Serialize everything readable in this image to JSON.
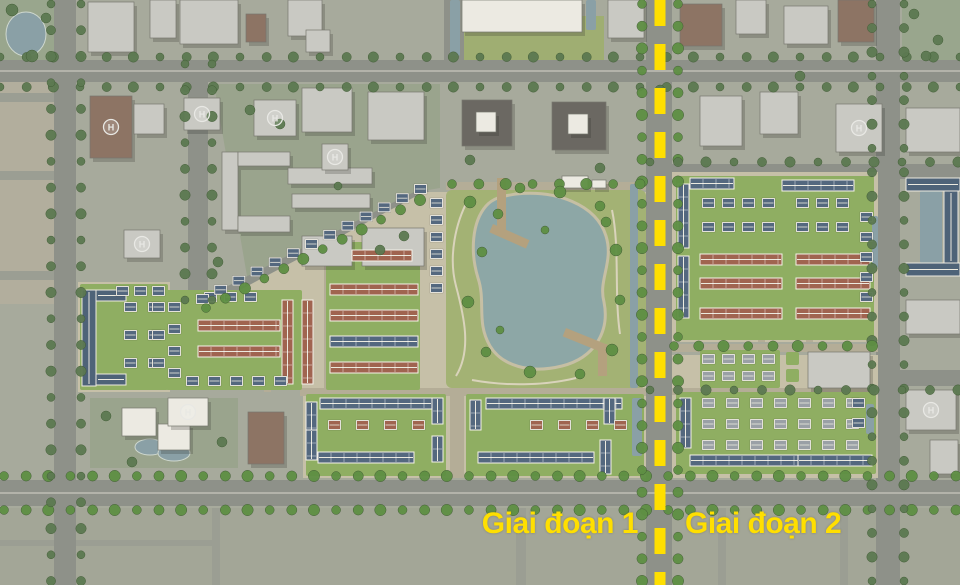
{
  "labels": {
    "phase1": "Giai đoạn 1",
    "phase2": "Giai đoạn 2"
  },
  "colors": {
    "bg": "#a7aa9c",
    "road": "#8e9189",
    "roadLine": "#b3b3aa",
    "minor": "#b4ad97",
    "faintRoad": "#9b9e93",
    "tan": "#c6c0a8",
    "lawn": "#8fae62",
    "parkG": "#a3b274",
    "radialPark": "#9fae72",
    "water": "#8da7a6",
    "waterDim": "#8aa0a6",
    "sand": "#c6bfa4",
    "treeB": "#5e8f43",
    "treeD": "#5c7951",
    "treeEdge": "#3f5a33",
    "bldg": "#c9c9c3",
    "bldgW": "#eceae2",
    "brown": "#8d7464",
    "dark": "#6b6862",
    "bldgEdge": "#77776e",
    "roofBlue": "#54687f",
    "roofRed": "#a06450",
    "roofGray": "#9aa0a6",
    "bar": "#4e6378",
    "ridge": "#eceadf",
    "pier": "#b4a17e",
    "beige": "#b2ae9d",
    "schoolTint": "#9aa48d",
    "parkTint": "#99a68d",
    "bottomBand": "#a3a697",
    "accent": "#ffdf00"
  },
  "map": {
    "w": 960,
    "h": 585,
    "helipad_glyph": "H",
    "parcels": [
      {
        "r": [
          0,
          0,
          58,
          66
        ],
        "f": "parkTint"
      },
      {
        "r": [
          902,
          0,
          58,
          62
        ],
        "f": "parkTint"
      },
      {
        "r": [
          0,
          66,
          56,
          160
        ],
        "f": "beige"
      },
      {
        "r": [
          0,
          226,
          56,
          78
        ],
        "f": "beige"
      },
      {
        "p": "214,84 440,84 440,188 416,192 248,282",
        "f": "schoolTint"
      },
      {
        "r": [
          90,
          398,
          148,
          70
        ],
        "f": "schoolTint"
      },
      {
        "r": [
          444,
          16,
          160,
          66
        ],
        "f": "radialPark"
      },
      {
        "r": [
          0,
          508,
          960,
          77
        ],
        "f": "bottomBand"
      }
    ],
    "faintRoads": [
      [
        212,
        508,
        8,
        77
      ],
      [
        516,
        508,
        10,
        77
      ],
      [
        718,
        508,
        8,
        77
      ],
      [
        840,
        508,
        8,
        77
      ],
      [
        0,
        540,
        212,
        6
      ],
      [
        58,
        508,
        8,
        77
      ],
      [
        0,
        93,
        56,
        9
      ],
      [
        0,
        171,
        56,
        9
      ],
      [
        0,
        271,
        56,
        9
      ]
    ],
    "roads": [
      [
        0,
        60,
        960,
        22
      ],
      [
        0,
        480,
        960,
        26
      ],
      [
        648,
        164,
        312,
        15
      ],
      [
        648,
        370,
        312,
        16
      ],
      [
        54,
        0,
        22,
        585
      ],
      [
        188,
        60,
        20,
        246
      ],
      [
        444,
        0,
        20,
        62
      ],
      [
        646,
        0,
        26,
        585
      ],
      [
        876,
        0,
        24,
        585
      ]
    ],
    "roadLines": [
      [
        0,
        70,
        960,
        2
      ],
      [
        0,
        492,
        960,
        2
      ]
    ],
    "diagRoads": [
      [
        206,
        302,
        424,
        192,
        9
      ]
    ],
    "bright": [
      {
        "r": [
          78,
          282,
          92,
          110
        ]
      },
      {
        "p": "170,290 240,290 424,192 646,192 646,478 303,478 303,390 170,390"
      },
      {
        "r": [
          672,
          172,
          206,
          170
        ]
      },
      {
        "r": [
          672,
          355,
          206,
          123
        ]
      }
    ],
    "minorRoads": [
      [
        300,
        388,
        346,
        8
      ],
      [
        446,
        182,
        200,
        8
      ],
      [
        450,
        392,
        14,
        86
      ],
      [
        672,
        344,
        206,
        8
      ],
      [
        672,
        388,
        206,
        7
      ],
      [
        758,
        178,
        7,
        164
      ],
      [
        806,
        178,
        7,
        164
      ],
      [
        324,
        242,
        7,
        146
      ],
      [
        264,
        298,
        7,
        94
      ]
    ],
    "lawns": [
      [
        80,
        284,
        88,
        106
      ],
      [
        166,
        290,
        136,
        100
      ],
      [
        326,
        242,
        94,
        148
      ],
      [
        306,
        394,
        140,
        82
      ],
      [
        466,
        394,
        178,
        82
      ],
      [
        676,
        176,
        198,
        164
      ],
      [
        676,
        392,
        200,
        82
      ],
      [
        700,
        350,
        80,
        38
      ],
      [
        786,
        352,
        13,
        13
      ],
      [
        786,
        369,
        13,
        13
      ]
    ],
    "park": {
      "rect": [
        446,
        190,
        200,
        198
      ],
      "lake": "M516,194 C556,190 596,204 606,236 C614,262 598,280 604,302 C610,332 594,358 562,366 C530,374 502,366 490,346 C476,322 486,302 478,278 C470,252 472,222 486,206 C494,197 504,196 516,194 Z",
      "paths": [
        "M456,376 C472,350 464,316 456,286 C448,256 456,222 468,200",
        "M472,380 C504,386 544,386 576,378",
        "M612,210 C620,248 614,294 620,334"
      ],
      "piers": [
        [
          497,
          178,
          9,
          52,
          0
        ],
        [
          493,
          224,
          40,
          9,
          24
        ],
        [
          598,
          344,
          9,
          32,
          0
        ],
        [
          566,
          328,
          42,
          9,
          22
        ]
      ]
    },
    "canals": [
      [
        450,
        0,
        10,
        56
      ],
      [
        586,
        0,
        10,
        30
      ],
      [
        630,
        184,
        8,
        204
      ],
      [
        866,
        404,
        8,
        30
      ],
      [
        632,
        398,
        10,
        58
      ],
      [
        920,
        191,
        22,
        72
      ],
      [
        872,
        216,
        6,
        52
      ]
    ],
    "pools": [
      [
        26,
        34,
        20,
        22
      ],
      [
        150,
        447,
        15,
        8
      ],
      [
        174,
        453,
        16,
        8
      ]
    ],
    "buildings": [
      [
        88,
        2,
        46,
        50,
        "g"
      ],
      [
        150,
        0,
        26,
        38,
        "g"
      ],
      [
        180,
        0,
        58,
        44,
        "g"
      ],
      [
        246,
        14,
        20,
        28,
        "b"
      ],
      [
        288,
        0,
        34,
        36,
        "g"
      ],
      [
        306,
        30,
        24,
        22,
        "g"
      ],
      [
        462,
        0,
        120,
        32,
        "w"
      ],
      [
        608,
        0,
        36,
        38,
        "g"
      ],
      [
        680,
        4,
        42,
        42,
        "b"
      ],
      [
        736,
        0,
        30,
        34,
        "g"
      ],
      [
        784,
        6,
        44,
        38,
        "g"
      ],
      [
        838,
        0,
        36,
        42,
        "b"
      ],
      [
        90,
        96,
        42,
        62,
        "b"
      ],
      [
        134,
        104,
        30,
        30,
        "g"
      ],
      [
        124,
        230,
        36,
        28,
        "g"
      ],
      [
        184,
        98,
        36,
        32,
        "g"
      ],
      [
        254,
        100,
        42,
        36,
        "g"
      ],
      [
        302,
        88,
        50,
        44,
        "g"
      ],
      [
        368,
        92,
        56,
        48,
        "g"
      ],
      [
        462,
        100,
        50,
        46,
        "d"
      ],
      [
        476,
        112,
        20,
        20,
        "w"
      ],
      [
        552,
        102,
        54,
        48,
        "d"
      ],
      [
        568,
        114,
        20,
        20,
        "w"
      ],
      [
        700,
        96,
        42,
        50,
        "g"
      ],
      [
        760,
        92,
        38,
        42,
        "g"
      ],
      [
        836,
        104,
        46,
        48,
        "g"
      ],
      [
        906,
        108,
        54,
        44,
        "g"
      ],
      [
        222,
        152,
        16,
        78,
        "g"
      ],
      [
        238,
        152,
        52,
        14,
        "g"
      ],
      [
        238,
        216,
        52,
        16,
        "g"
      ],
      [
        288,
        168,
        84,
        16,
        "g"
      ],
      [
        292,
        194,
        78,
        14,
        "g"
      ],
      [
        322,
        144,
        26,
        26,
        "g"
      ],
      [
        362,
        228,
        62,
        38,
        "g"
      ],
      [
        302,
        236,
        50,
        30,
        "g"
      ],
      [
        122,
        408,
        34,
        28,
        "w"
      ],
      [
        158,
        424,
        32,
        26,
        "w"
      ],
      [
        168,
        398,
        40,
        28,
        "w"
      ],
      [
        248,
        412,
        36,
        52,
        "b"
      ],
      [
        906,
        300,
        54,
        34,
        "g"
      ],
      [
        906,
        390,
        50,
        40,
        "g"
      ],
      [
        930,
        440,
        28,
        34,
        "g"
      ],
      [
        562,
        176,
        26,
        12,
        "w"
      ],
      [
        592,
        180,
        14,
        8,
        "w"
      ],
      [
        808,
        352,
        62,
        36,
        "g"
      ]
    ],
    "bars": [
      [
        82,
        290,
        14,
        96
      ],
      [
        96,
        290,
        30,
        11
      ],
      [
        96,
        374,
        30,
        11
      ],
      [
        906,
        178,
        54,
        13
      ],
      [
        944,
        191,
        14,
        72
      ],
      [
        906,
        263,
        54,
        13
      ]
    ],
    "rowh": [
      [
        282,
        300,
        84,
        "v",
        "red"
      ],
      [
        302,
        300,
        84,
        "v",
        "red"
      ],
      [
        198,
        320,
        82,
        "h",
        "red"
      ],
      [
        198,
        346,
        82,
        "h",
        "red"
      ],
      [
        330,
        284,
        88,
        "h",
        "red"
      ],
      [
        330,
        310,
        88,
        "h",
        "red"
      ],
      [
        330,
        336,
        88,
        "h",
        "blue"
      ],
      [
        330,
        362,
        88,
        "h",
        "red"
      ],
      [
        352,
        250,
        60,
        "h",
        "red"
      ],
      [
        320,
        398,
        112,
        "h",
        "blue"
      ],
      [
        306,
        402,
        44,
        "v",
        "blue"
      ],
      [
        318,
        452,
        96,
        "h",
        "blue"
      ],
      [
        306,
        430,
        30,
        "v",
        "blue"
      ],
      [
        432,
        398,
        26,
        "v",
        "blue"
      ],
      [
        432,
        436,
        26,
        "v",
        "blue"
      ],
      [
        486,
        398,
        136,
        "h",
        "blue"
      ],
      [
        470,
        400,
        30,
        "v",
        "blue"
      ],
      [
        478,
        452,
        116,
        "h",
        "blue"
      ],
      [
        600,
        440,
        34,
        "v",
        "blue"
      ],
      [
        604,
        398,
        26,
        "v",
        "blue"
      ],
      [
        678,
        184,
        64,
        "v",
        "blue"
      ],
      [
        678,
        256,
        62,
        "v",
        "blue"
      ],
      [
        690,
        178,
        44,
        "h",
        "blue"
      ],
      [
        782,
        180,
        72,
        "h",
        "blue"
      ],
      [
        700,
        254,
        82,
        "h",
        "red"
      ],
      [
        700,
        278,
        82,
        "h",
        "red"
      ],
      [
        796,
        254,
        74,
        "h",
        "red"
      ],
      [
        796,
        278,
        74,
        "h",
        "red"
      ],
      [
        700,
        308,
        82,
        "h",
        "red"
      ],
      [
        796,
        308,
        74,
        "h",
        "red"
      ],
      [
        680,
        398,
        50,
        "v",
        "blue"
      ],
      [
        690,
        455,
        148,
        "h",
        "blue"
      ],
      [
        798,
        455,
        74,
        "h",
        "blue"
      ]
    ],
    "villas": [
      [
        124,
        302,
        2,
        3,
        24,
        28,
        "blue"
      ],
      [
        116,
        286,
        3,
        1,
        18,
        0,
        "blue"
      ],
      [
        152,
        302,
        1,
        3,
        0,
        28,
        "blue"
      ],
      [
        168,
        302,
        1,
        4,
        0,
        22,
        "blue"
      ],
      [
        204,
        292,
        3,
        1,
        20,
        0,
        "blue"
      ],
      [
        186,
        376,
        5,
        1,
        22,
        0,
        "blue"
      ],
      [
        430,
        198,
        1,
        6,
        0,
        17,
        "blue"
      ],
      [
        328,
        420,
        4,
        1,
        28,
        0,
        "red"
      ],
      [
        530,
        420,
        4,
        1,
        28,
        0,
        "red"
      ],
      [
        702,
        198,
        4,
        2,
        20,
        24,
        "blue"
      ],
      [
        796,
        198,
        3,
        2,
        20,
        24,
        "blue"
      ],
      [
        860,
        212,
        1,
        5,
        0,
        20,
        "blue"
      ],
      [
        702,
        354,
        4,
        2,
        20,
        17,
        "gray"
      ],
      [
        702,
        398,
        7,
        3,
        24,
        21,
        "gray"
      ],
      [
        852,
        398,
        1,
        2,
        0,
        20,
        "blue"
      ]
    ],
    "villarows": [
      {
        "x1": 196,
        "y1": 294,
        "x2": 414,
        "y2": 184,
        "n": 13
      }
    ],
    "helipads": [
      [
        111,
        127
      ],
      [
        142,
        244
      ],
      [
        202,
        114
      ],
      [
        275,
        118
      ],
      [
        335,
        157
      ],
      [
        188,
        412
      ],
      [
        859,
        128
      ],
      [
        931,
        410
      ]
    ],
    "treelines": [
      [
        0,
        57,
        960,
        57,
        26,
        "d"
      ],
      [
        0,
        87,
        960,
        87,
        26,
        "d"
      ],
      [
        4,
        476,
        956,
        476,
        22,
        "b"
      ],
      [
        4,
        510,
        956,
        510,
        22,
        "b"
      ],
      [
        51,
        4,
        51,
        581,
        26,
        "d"
      ],
      [
        81,
        4,
        81,
        581,
        26,
        "d"
      ],
      [
        185,
        64,
        185,
        300,
        24,
        "d"
      ],
      [
        212,
        64,
        212,
        300,
        24,
        "d"
      ],
      [
        642,
        4,
        642,
        581,
        22,
        "b"
      ],
      [
        678,
        4,
        678,
        581,
        22,
        "b"
      ],
      [
        872,
        4,
        872,
        581,
        24,
        "d"
      ],
      [
        904,
        4,
        904,
        581,
        24,
        "d"
      ],
      [
        206,
        308,
        420,
        200,
        20,
        "b"
      ],
      [
        452,
        184,
        640,
        184,
        24,
        "b"
      ],
      [
        650,
        162,
        958,
        162,
        26,
        "d"
      ],
      [
        650,
        390,
        958,
        390,
        26,
        "d"
      ],
      [
        674,
        346,
        872,
        346,
        24,
        "b"
      ]
    ],
    "trees": [
      [
        470,
        202,
        6,
        "b"
      ],
      [
        482,
        252,
        5,
        "b"
      ],
      [
        468,
        302,
        6,
        "b"
      ],
      [
        486,
        352,
        5,
        "b"
      ],
      [
        530,
        372,
        6,
        "b"
      ],
      [
        580,
        374,
        5,
        "b"
      ],
      [
        612,
        350,
        6,
        "b"
      ],
      [
        620,
        300,
        5,
        "b"
      ],
      [
        616,
        250,
        6,
        "b"
      ],
      [
        600,
        206,
        5,
        "b"
      ],
      [
        560,
        192,
        6,
        "b"
      ],
      [
        520,
        188,
        5,
        "b"
      ],
      [
        498,
        214,
        5,
        "b"
      ],
      [
        606,
        222,
        5,
        "b"
      ],
      [
        545,
        230,
        4,
        "b"
      ],
      [
        500,
        330,
        4,
        "b"
      ],
      [
        250,
        110,
        5,
        "d"
      ],
      [
        280,
        124,
        5,
        "d"
      ],
      [
        380,
        250,
        5,
        "d"
      ],
      [
        404,
        236,
        5,
        "d"
      ],
      [
        218,
        262,
        5,
        "d"
      ],
      [
        338,
        186,
        4,
        "d"
      ],
      [
        106,
        416,
        5,
        "d"
      ],
      [
        132,
        462,
        5,
        "d"
      ],
      [
        222,
        442,
        5,
        "d"
      ],
      [
        12,
        10,
        6,
        "d"
      ],
      [
        32,
        56,
        6,
        "d"
      ],
      [
        46,
        18,
        5,
        "d"
      ],
      [
        914,
        14,
        5,
        "d"
      ],
      [
        938,
        40,
        5,
        "d"
      ],
      [
        926,
        56,
        5,
        "d"
      ],
      [
        660,
        90,
        5,
        "d"
      ],
      [
        800,
        76,
        5,
        "d"
      ],
      [
        470,
        160,
        5,
        "d"
      ],
      [
        600,
        168,
        5,
        "d"
      ]
    ],
    "boundary": {
      "x": 660,
      "w": 11,
      "dash": "26 18"
    }
  }
}
